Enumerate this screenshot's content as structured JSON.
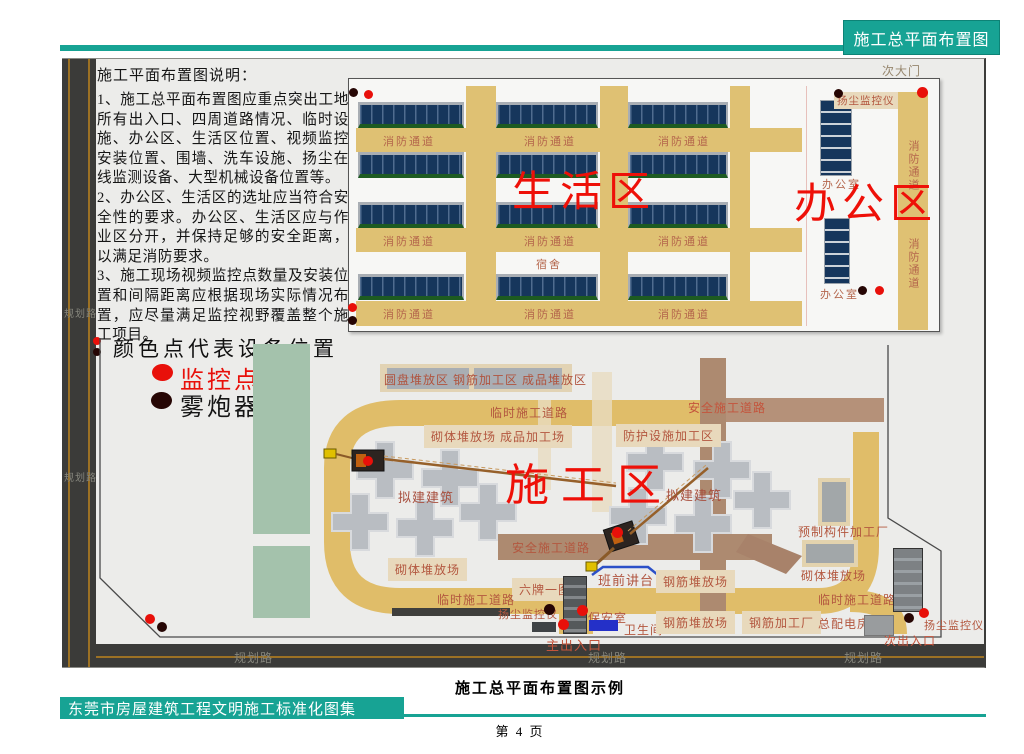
{
  "page": {
    "header_tab": "施工总平面布置图",
    "caption": "施工总平面布置图示例",
    "footer_title": "东莞市房屋建筑工程文明施工标准化图集",
    "page_number": "第 4 页",
    "accent_teal": "#17a394"
  },
  "notes": {
    "title": "施工平面布置图说明：",
    "items": [
      "1、施工总平面布置图应重点突出工地所有出入口、四周道路情况、临时设施、办公区、生活区位置、视频监控安装位置、围墙、洗车设施、扬尘在线监测设备、大型机械设备位置等。",
      "2、办公区、生活区的选址应当符合安全性的要求。办公区、生活区应与作业区分开，并保持足够的安全距离，以满足消防要求。",
      "3、施工现场视频监控点数量及安装位置和间隔距离应根据现场实际情况布置，应尽量满足监控视野覆盖整个施工项目。"
    ]
  },
  "legend": {
    "title": "颜色点代表设备位置",
    "monitor_point": {
      "label": "监控点",
      "color": "#e8100a"
    },
    "fog_cannon": {
      "label": "雾炮器",
      "color": "#260604"
    }
  },
  "upper_plan": {
    "living_zone": "生活区",
    "office_zone": "办公区",
    "fire_lane": "消防通道",
    "dormitory": "宿舍",
    "office_room": "办公室",
    "secondary_gate": "次大门",
    "dust_monitor": "扬尘监控仪"
  },
  "lower_plan": {
    "construction_zone": "施工区",
    "storage_strip": "圆盘堆放区 钢筋加工区 成品堆放区",
    "temp_road": "临时施工道路",
    "safe_road": "安全施工道路",
    "masonry_finished": "砌体堆放场  成品加工场",
    "protection_area": "防护设施加工区",
    "proposed_building": "拟建建筑",
    "precast_factory": "预制构件加工厂",
    "masonry_yard": "砌体堆放场",
    "six_boards": "六牌一图",
    "pre_shift_platform": "班前讲台",
    "rebar_yard": "钢筋堆放场",
    "rebar_factory": "钢筋加工厂",
    "main_power_room": "总配电房",
    "dust_monitor": "扬尘监控仪",
    "security_room": "保安室",
    "toilet": "卫生间",
    "main_gate": "主出入口",
    "secondary_exit": "次出入口",
    "planned_road": "规划路"
  }
}
